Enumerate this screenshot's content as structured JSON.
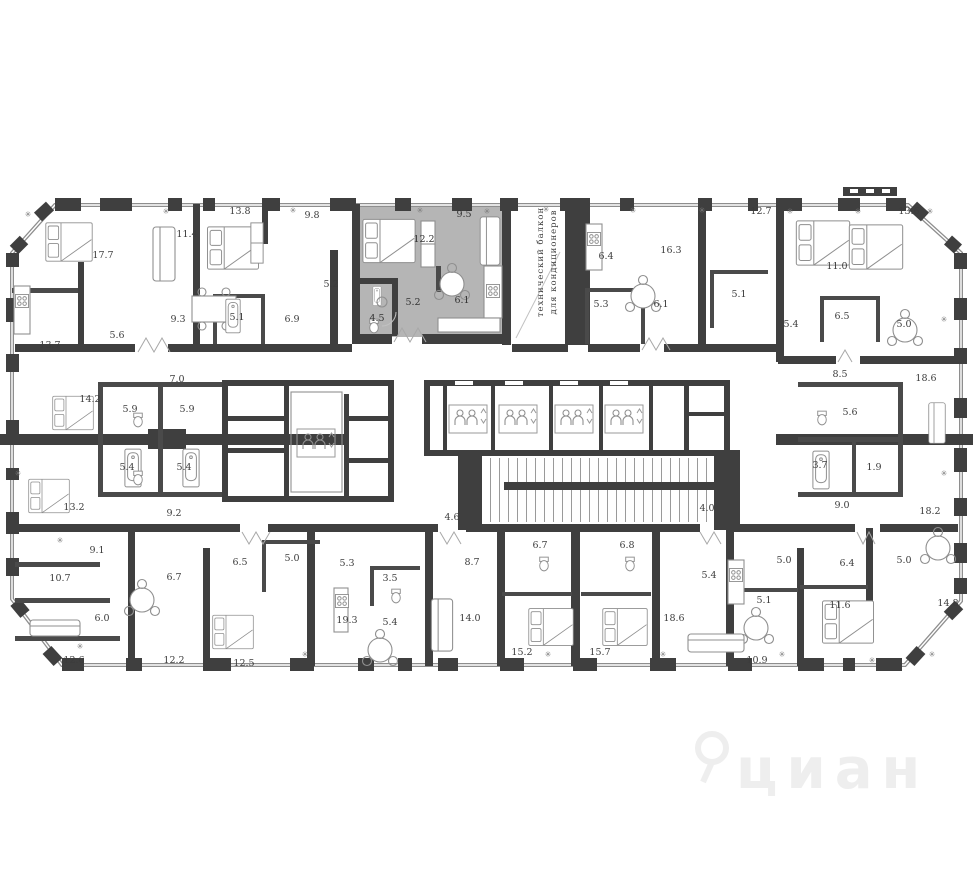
{
  "plan": {
    "type": "residential-floor-plan",
    "colors": {
      "wall": "#3f3f3f",
      "window": "#8e8e8e",
      "highlight": "#b5b5b5",
      "furniture": "#8f8f8f",
      "label": "#3c3c3c",
      "watermark": "#eeeeee"
    },
    "balcony_note": {
      "line1": "технический балкон",
      "line2": "для кондиционеров"
    },
    "watermark": "циан",
    "room_labels": [
      {
        "t": "17.7",
        "x": 103,
        "y": 258
      },
      {
        "t": "11.4",
        "x": 187,
        "y": 237
      },
      {
        "t": "13.8",
        "x": 240,
        "y": 214
      },
      {
        "t": "9.8",
        "x": 312,
        "y": 218
      },
      {
        "t": "5.2",
        "x": 331,
        "y": 287
      },
      {
        "t": "9.3",
        "x": 178,
        "y": 322
      },
      {
        "t": "5.6",
        "x": 117,
        "y": 338
      },
      {
        "t": "13.7",
        "x": 50,
        "y": 348
      },
      {
        "t": "5.1",
        "x": 237,
        "y": 320
      },
      {
        "t": "6.9",
        "x": 292,
        "y": 322
      },
      {
        "t": "7.0",
        "x": 177,
        "y": 382
      },
      {
        "t": "12.2",
        "x": 424,
        "y": 242,
        "hl": true
      },
      {
        "t": "9.5",
        "x": 464,
        "y": 217,
        "hl": true
      },
      {
        "t": "5.2",
        "x": 413,
        "y": 305,
        "hl": true
      },
      {
        "t": "4.5",
        "x": 377,
        "y": 321,
        "hl": true
      },
      {
        "t": "6.1",
        "x": 462,
        "y": 303,
        "hl": true
      },
      {
        "t": "6.4",
        "x": 606,
        "y": 259
      },
      {
        "t": "16.3",
        "x": 671,
        "y": 253
      },
      {
        "t": "12.7",
        "x": 761,
        "y": 214
      },
      {
        "t": "5.3",
        "x": 601,
        "y": 307
      },
      {
        "t": "6.1",
        "x": 661,
        "y": 307
      },
      {
        "t": "5.1",
        "x": 739,
        "y": 297
      },
      {
        "t": "11.0",
        "x": 837,
        "y": 269
      },
      {
        "t": "13.6",
        "x": 909,
        "y": 214
      },
      {
        "t": "5.4",
        "x": 791,
        "y": 327
      },
      {
        "t": "6.5",
        "x": 842,
        "y": 319
      },
      {
        "t": "5.0",
        "x": 904,
        "y": 327
      },
      {
        "t": "8.5",
        "x": 840,
        "y": 377
      },
      {
        "t": "18.6",
        "x": 926,
        "y": 381
      },
      {
        "t": "14.2",
        "x": 90,
        "y": 402
      },
      {
        "t": "5.9",
        "x": 130,
        "y": 412
      },
      {
        "t": "5.9",
        "x": 187,
        "y": 412
      },
      {
        "t": "5.4",
        "x": 127,
        "y": 470
      },
      {
        "t": "5.4",
        "x": 184,
        "y": 470
      },
      {
        "t": "13.2",
        "x": 74,
        "y": 510
      },
      {
        "t": "9.2",
        "x": 174,
        "y": 516
      },
      {
        "t": "5.6",
        "x": 850,
        "y": 415
      },
      {
        "t": "3.7",
        "x": 820,
        "y": 468
      },
      {
        "t": "1.9",
        "x": 874,
        "y": 470
      },
      {
        "t": "9.0",
        "x": 842,
        "y": 508
      },
      {
        "t": "18.2",
        "x": 930,
        "y": 514
      },
      {
        "t": "4.6",
        "x": 452,
        "y": 520
      },
      {
        "t": "4.0",
        "x": 707,
        "y": 511
      },
      {
        "t": "9.1",
        "x": 97,
        "y": 553
      },
      {
        "t": "10.7",
        "x": 60,
        "y": 581
      },
      {
        "t": "6.0",
        "x": 102,
        "y": 621
      },
      {
        "t": "12.6",
        "x": 74,
        "y": 663
      },
      {
        "t": "6.7",
        "x": 174,
        "y": 580
      },
      {
        "t": "6.5",
        "x": 240,
        "y": 565
      },
      {
        "t": "5.0",
        "x": 292,
        "y": 561
      },
      {
        "t": "12.2",
        "x": 174,
        "y": 663
      },
      {
        "t": "12.5",
        "x": 244,
        "y": 666
      },
      {
        "t": "5.3",
        "x": 347,
        "y": 566
      },
      {
        "t": "3.5",
        "x": 390,
        "y": 581
      },
      {
        "t": "19.3",
        "x": 347,
        "y": 623
      },
      {
        "t": "5.4",
        "x": 390,
        "y": 625
      },
      {
        "t": "8.7",
        "x": 472,
        "y": 565
      },
      {
        "t": "14.0",
        "x": 470,
        "y": 621
      },
      {
        "t": "6.7",
        "x": 540,
        "y": 548
      },
      {
        "t": "6.8",
        "x": 627,
        "y": 548
      },
      {
        "t": "15.2",
        "x": 522,
        "y": 655
      },
      {
        "t": "15.7",
        "x": 600,
        "y": 655
      },
      {
        "t": "18.6",
        "x": 674,
        "y": 621
      },
      {
        "t": "5.4",
        "x": 709,
        "y": 578
      },
      {
        "t": "5.0",
        "x": 784,
        "y": 563
      },
      {
        "t": "5.1",
        "x": 764,
        "y": 603
      },
      {
        "t": "10.9",
        "x": 757,
        "y": 663
      },
      {
        "t": "6.4",
        "x": 847,
        "y": 566
      },
      {
        "t": "5.0",
        "x": 904,
        "y": 563
      },
      {
        "t": "11.6",
        "x": 840,
        "y": 608
      },
      {
        "t": "14.8",
        "x": 948,
        "y": 606
      }
    ],
    "ac_marks": [
      [
        28,
        217
      ],
      [
        166,
        214
      ],
      [
        293,
        213
      ],
      [
        420,
        213
      ],
      [
        487,
        214
      ],
      [
        546,
        212
      ],
      [
        633,
        213
      ],
      [
        702,
        213
      ],
      [
        790,
        214
      ],
      [
        858,
        214
      ],
      [
        930,
        214
      ],
      [
        18,
        476
      ],
      [
        944,
        322
      ],
      [
        944,
        476
      ],
      [
        80,
        649
      ],
      [
        305,
        657
      ],
      [
        548,
        657
      ],
      [
        663,
        657
      ],
      [
        782,
        657
      ],
      [
        872,
        663
      ],
      [
        932,
        657
      ],
      [
        60,
        543
      ]
    ],
    "lifts": [
      [
        296,
        428
      ],
      [
        448,
        404
      ],
      [
        498,
        404
      ],
      [
        554,
        404
      ],
      [
        604,
        404
      ]
    ]
  }
}
